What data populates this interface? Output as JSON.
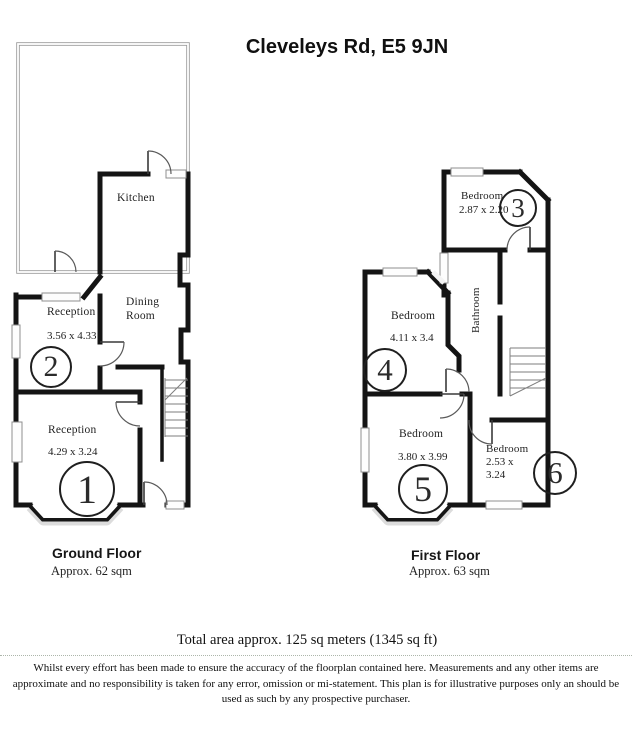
{
  "title": "Cleveleys Rd, E5 9JN",
  "floors": {
    "ground": {
      "name": "Ground Floor",
      "area": "Approx. 62 sqm",
      "rooms": {
        "kitchen": {
          "label": "Kitchen"
        },
        "dining": {
          "label": "Dining Room"
        },
        "reception2": {
          "label": "Reception",
          "dims": "3.56 x 4.33",
          "zone": "2"
        },
        "reception1": {
          "label": "Reception",
          "dims": "4.29 x 3.24",
          "zone": "1"
        }
      }
    },
    "first": {
      "name": "First Floor",
      "area": "Approx. 63 sqm",
      "rooms": {
        "bedroom3": {
          "label": "Bedroom",
          "dims": "2.87 x 2.20",
          "zone": "3"
        },
        "bathroom": {
          "label": "Bathroom"
        },
        "bedroom4": {
          "label": "Bedroom",
          "dims": "4.11 x 3.4",
          "zone": "4"
        },
        "bedroom5": {
          "label": "Bedroom",
          "dims": "3.80 x 3.99",
          "zone": "5"
        },
        "bedroom6": {
          "label": "Bedroom",
          "dims": "2.53 x 3.24",
          "zone": "6"
        }
      }
    }
  },
  "footer": {
    "total_area": "Total area approx. 125 sq meters (1345 sq ft)",
    "disclaimer": "Whilst every effort has been made to ensure the accuracy of the floorplan contained here. Measurements and any other items are approximate and no responsibility is taken for any error, omission or mi-statement. This plan is for illustrative purposes only an should be used as such by any prospective purchaser."
  }
}
